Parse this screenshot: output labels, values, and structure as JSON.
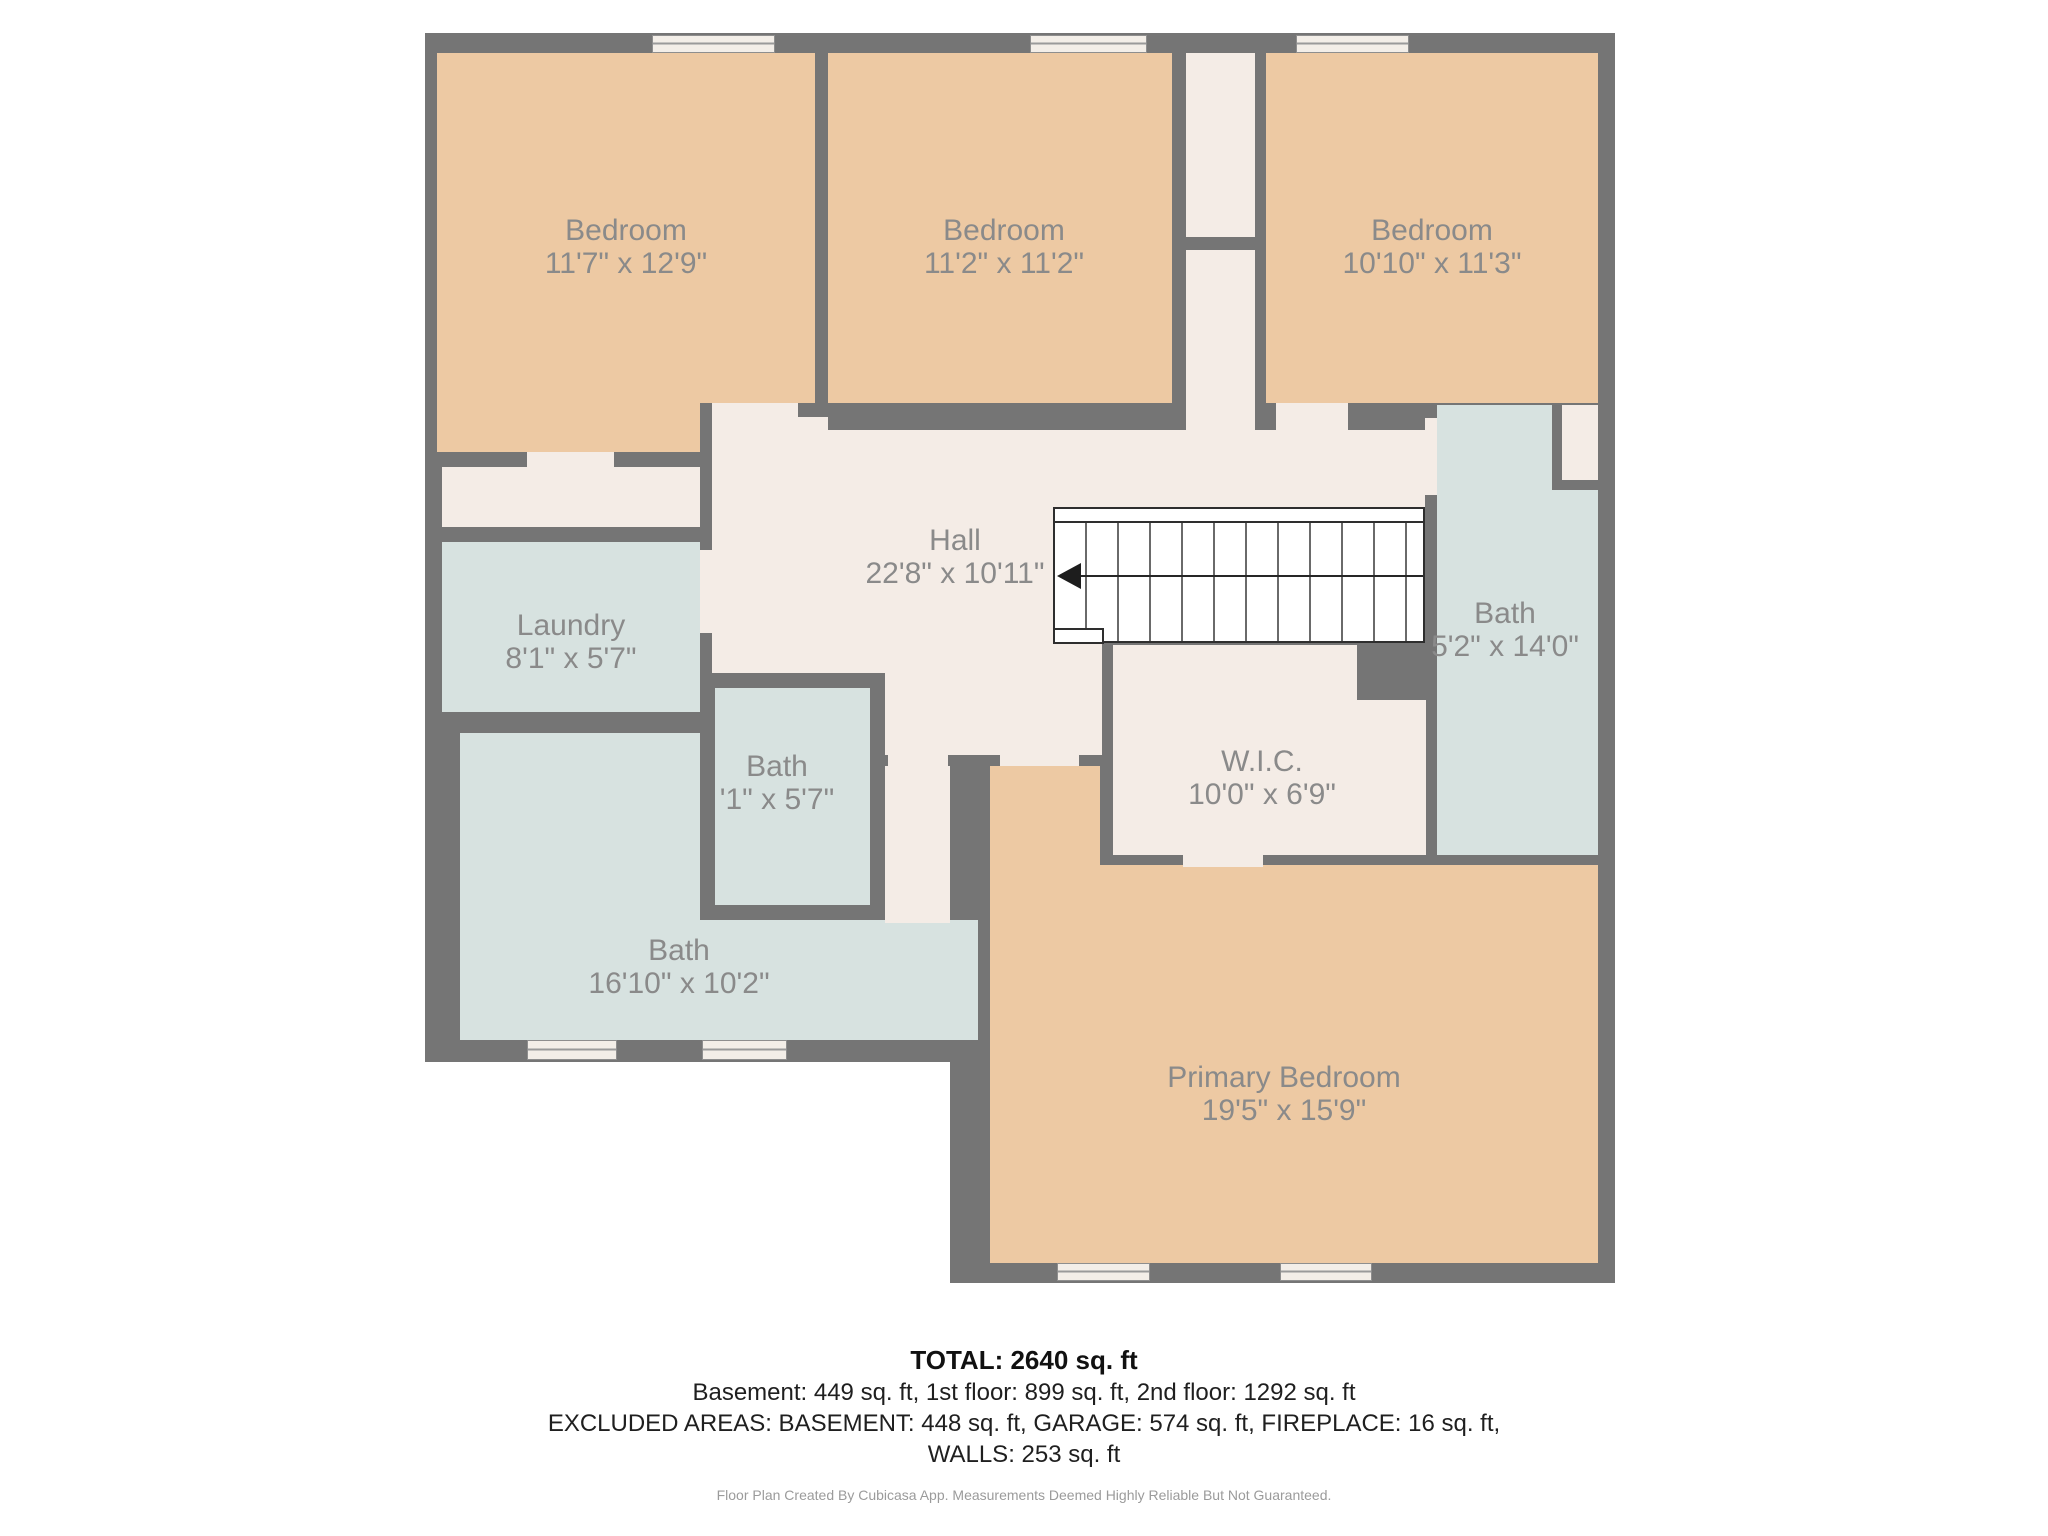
{
  "plan": {
    "rooms": [
      {
        "id": "bedroom-1",
        "label": "Bedroom",
        "dims": "11'7\" x 12'9\""
      },
      {
        "id": "bedroom-2",
        "label": "Bedroom",
        "dims": "11'2\" x 11'2\""
      },
      {
        "id": "bedroom-3",
        "label": "Bedroom",
        "dims": "10'10\" x 11'3\""
      },
      {
        "id": "hall",
        "label": "Hall",
        "dims": "22'8\" x 10'11\""
      },
      {
        "id": "laundry",
        "label": "Laundry",
        "dims": "8'1\" x 5'7\""
      },
      {
        "id": "bath-small",
        "label": "Bath",
        "dims": "'1\" x 5'7\""
      },
      {
        "id": "bath-main",
        "label": "Bath",
        "dims": "16'10\" x 10'2\""
      },
      {
        "id": "bath-right",
        "label": "Bath",
        "dims": "5'2\" x 14'0\""
      },
      {
        "id": "wic",
        "label": "W.I.C.",
        "dims": "10'0\" x 6'9\""
      },
      {
        "id": "primary-bedroom",
        "label": "Primary Bedroom",
        "dims": "19'5\" x 15'9\""
      }
    ],
    "colors": {
      "wall": "#757575",
      "room_tan": "#edc9a3",
      "room_blue": "#d7e2e0",
      "room_neutral": "#f4ece6",
      "stairs": "#ffffff",
      "label_text": "#8a8a8a"
    }
  },
  "summary": {
    "total": "TOTAL: 2640 sq. ft",
    "floors": "Basement: 449 sq. ft, 1st floor: 899 sq. ft, 2nd floor: 1292 sq. ft",
    "excluded": "EXCLUDED AREAS: BASEMENT: 448 sq. ft, GARAGE: 574 sq. ft, FIREPLACE: 16 sq. ft,",
    "walls": "WALLS: 253 sq. ft",
    "footer": "Floor Plan Created By Cubicasa App. Measurements Deemed Highly Reliable But Not Guaranteed."
  }
}
